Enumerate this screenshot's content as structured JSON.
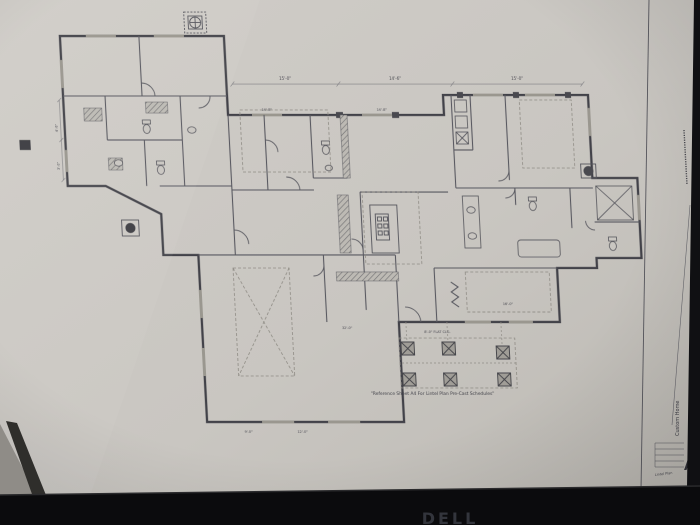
{
  "monitor": {
    "brand": "DELL"
  },
  "sheet": {
    "note": "\"Reference Sheet A4 For Lintel Plan Pre-Cast Schedules\"",
    "title_block": {
      "project": "Custom Home",
      "sheet_letter": "A",
      "sheet_name": "Lintel Plan"
    },
    "dims": {
      "top": [
        "15'-0\"",
        "14'-6\"",
        "15'-0\""
      ],
      "wall": [
        "14'-8\"",
        "14'-8\""
      ],
      "left": [
        "4'-6\"",
        "3'-0\""
      ],
      "bottom": [
        "32'-0\"",
        "16'-0\"",
        "9'-0\"",
        "12'-0\""
      ],
      "porch": "8'-0\" FLAT CLG."
    }
  },
  "colors": {
    "paper": "#c9c6c1",
    "ink": "#45454c",
    "bezel": "#0b0b0d"
  }
}
